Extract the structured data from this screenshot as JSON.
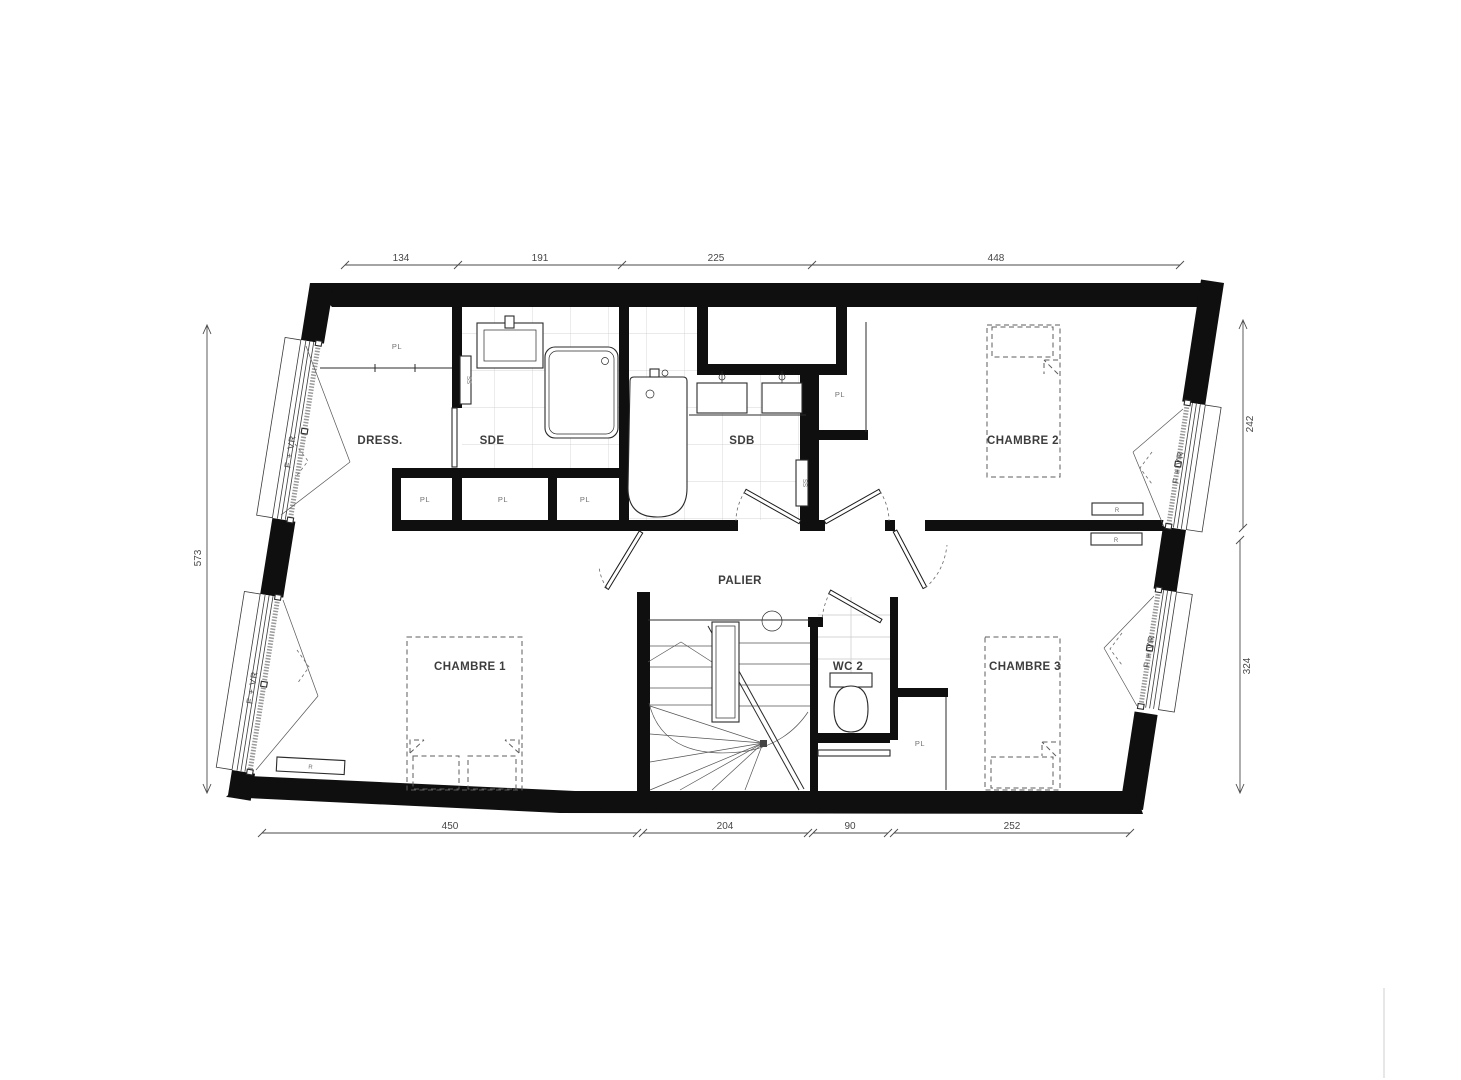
{
  "rooms": {
    "dress": "DRESS.",
    "sde": "SDE",
    "sdb": "SDB",
    "chambre1": "CHAMBRE 1",
    "chambre2": "CHAMBRE 2",
    "chambre3": "CHAMBRE 3",
    "palier": "PALIER",
    "wc2": "WC 2"
  },
  "abbrev": {
    "closet": "PL",
    "radiator": "R",
    "towel_rail": "SS",
    "window": "F + VR"
  },
  "dimensions_cm": {
    "top": [
      "134",
      "191",
      "225",
      "448"
    ],
    "left": [
      "573"
    ],
    "right": [
      "242",
      "324"
    ],
    "bottom": [
      "450",
      "204",
      "90",
      "252"
    ]
  },
  "colors": {
    "wall": "#0f0f0f",
    "line": "#2b2b2b",
    "tile": "#c9c9c9",
    "furniture_dash": "#5d5d5d",
    "background": "#ffffff"
  }
}
